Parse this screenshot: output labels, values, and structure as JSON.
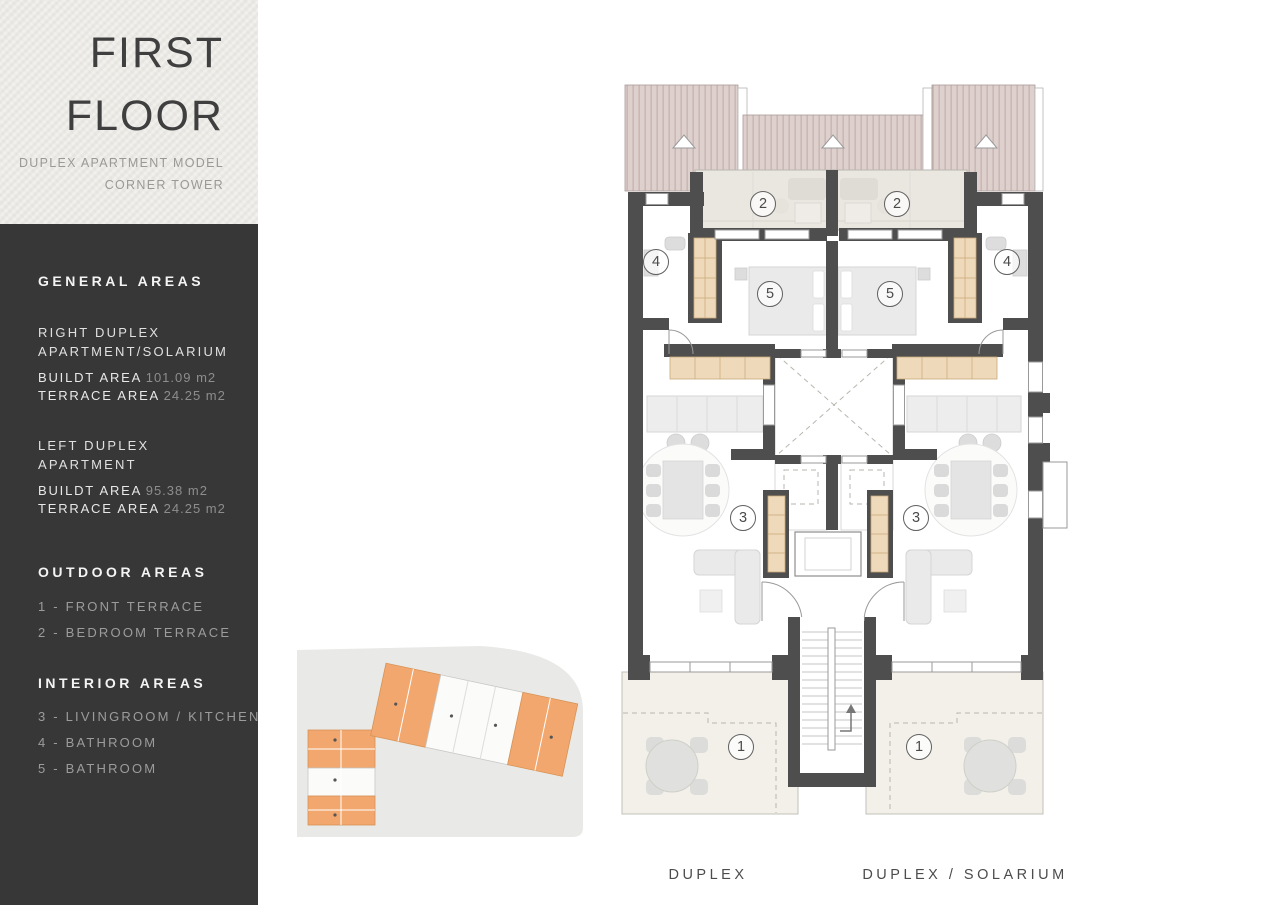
{
  "title_box": {
    "line1": "FIRST",
    "line2": "FLOOR",
    "subtitle_line1": "DUPLEX APARTMENT MODEL",
    "subtitle_line2": "CORNER TOWER"
  },
  "sidebar": {
    "general": {
      "heading": "GENERAL AREAS",
      "right_duplex": {
        "name_line1": "RIGHT DUPLEX",
        "name_line2": "APARTMENT/SOLARIUM",
        "built_label": "BUILDT AREA",
        "built_value": "101.09 m2",
        "terrace_label": "TERRACE AREA",
        "terrace_value": "24.25 m2"
      },
      "left_duplex": {
        "name_line1": "LEFT DUPLEX",
        "name_line2": "APARTMENT",
        "built_label": "BUILDT AREA",
        "built_value": "95.38 m2",
        "terrace_label": "TERRACE AREA",
        "terrace_value": "24.25 m2"
      }
    },
    "outdoor": {
      "heading": "OUTDOOR AREAS",
      "items": [
        "1 - FRONT TERRACE",
        "2 - BEDROOM TERRACE"
      ]
    },
    "interior": {
      "heading": "INTERIOR AREAS",
      "items": [
        "3 - LIVINGROOM / KITCHEN",
        "4 - BATHROOM",
        "5 - BATHROOM"
      ]
    }
  },
  "plan": {
    "captions": {
      "left": "DUPLEX",
      "right": "DUPLEX / SOLARIUM"
    },
    "circles": [
      {
        "n": "2"
      },
      {
        "n": "2"
      },
      {
        "n": "4"
      },
      {
        "n": "4"
      },
      {
        "n": "5"
      },
      {
        "n": "5"
      },
      {
        "n": "3"
      },
      {
        "n": "3"
      },
      {
        "n": "1"
      },
      {
        "n": "1"
      }
    ],
    "colors": {
      "wall": "#4e4e4e",
      "roof": "#ded0cc",
      "roof_stripe": "#c6b2af",
      "bedroom_terrace": "#eae7e1",
      "front_terrace": "#f2f0e9",
      "wardrobe": "#eed9ba",
      "sitemap_highlight": "#f1a76d",
      "sidebar_bg": "#373737",
      "title_bg": "#eae8e3"
    }
  }
}
